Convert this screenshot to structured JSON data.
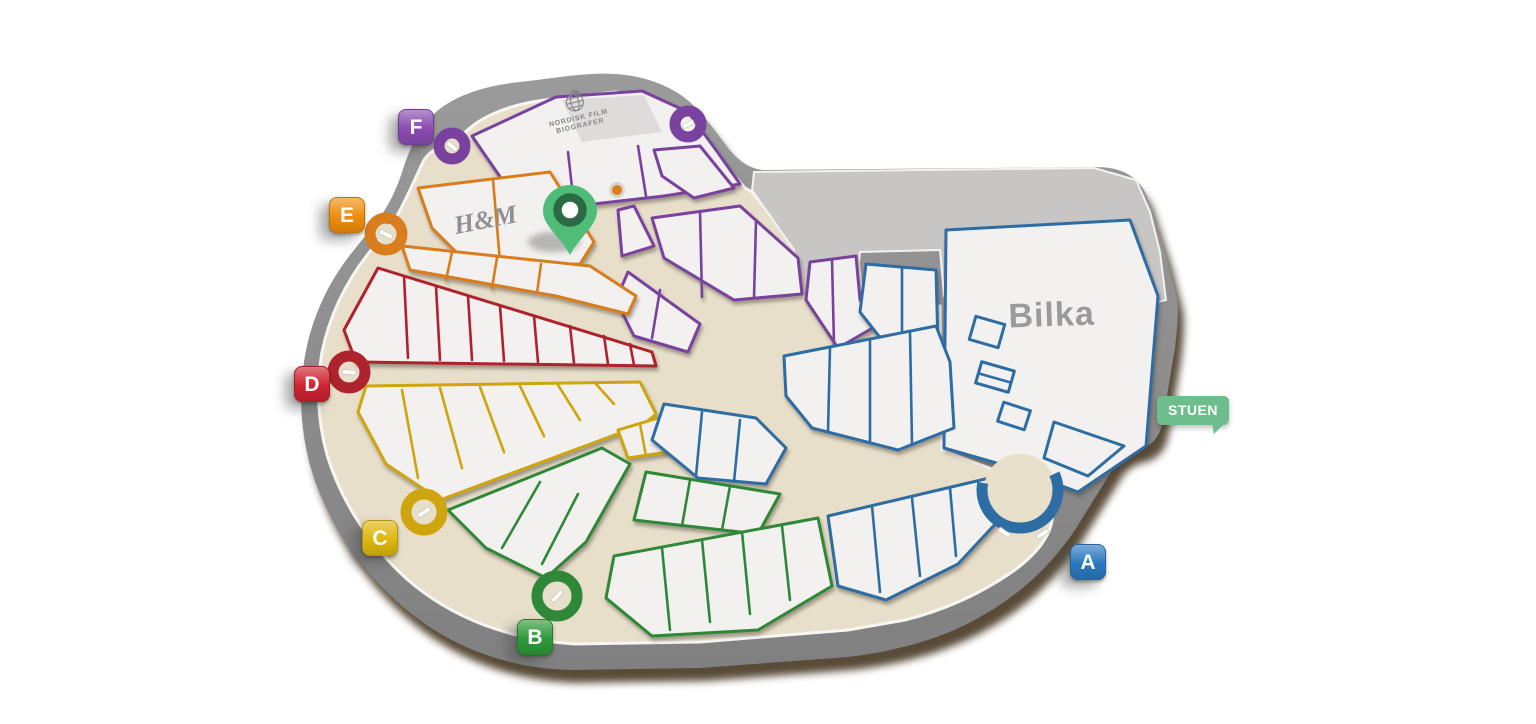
{
  "floor_label": {
    "text": "STUEN"
  },
  "entrances": [
    {
      "letter": "A",
      "color": "#2b78bf"
    },
    {
      "letter": "B",
      "color": "#2e9a39"
    },
    {
      "letter": "C",
      "color": "#ddb60e"
    },
    {
      "letter": "D",
      "color": "#cd2330"
    },
    {
      "letter": "E",
      "color": "#ee8d0d"
    },
    {
      "letter": "F",
      "color": "#8a4bb0"
    }
  ],
  "stores": {
    "bilka": {
      "name": "Bilka"
    },
    "hm": {
      "name": "H&M"
    },
    "cinema": {
      "line1": "NORDISK FILM",
      "line2": "BIOGRAFER"
    }
  },
  "markers": {
    "current_location_pin": {
      "color": "#4fbd77"
    },
    "poi_dot": {
      "color": "#e0891f"
    }
  },
  "theme": {
    "purple": "#7a429f",
    "orange": "#d97d1e",
    "red": "#ae242e",
    "yellow": "#cfa50f",
    "green": "#2e8838",
    "blue": "#2e6da4",
    "base": "#8d8d8d",
    "plateau": "#c7c6c5",
    "beige": "#e7dfca",
    "unit": "#f2f1ef",
    "shadow": "#463824",
    "label-gray": "#9a999b",
    "stuen-green": "#6ebd8c",
    "pin-green": "#4fbd77",
    "pin-dark": "#2a6b44"
  }
}
